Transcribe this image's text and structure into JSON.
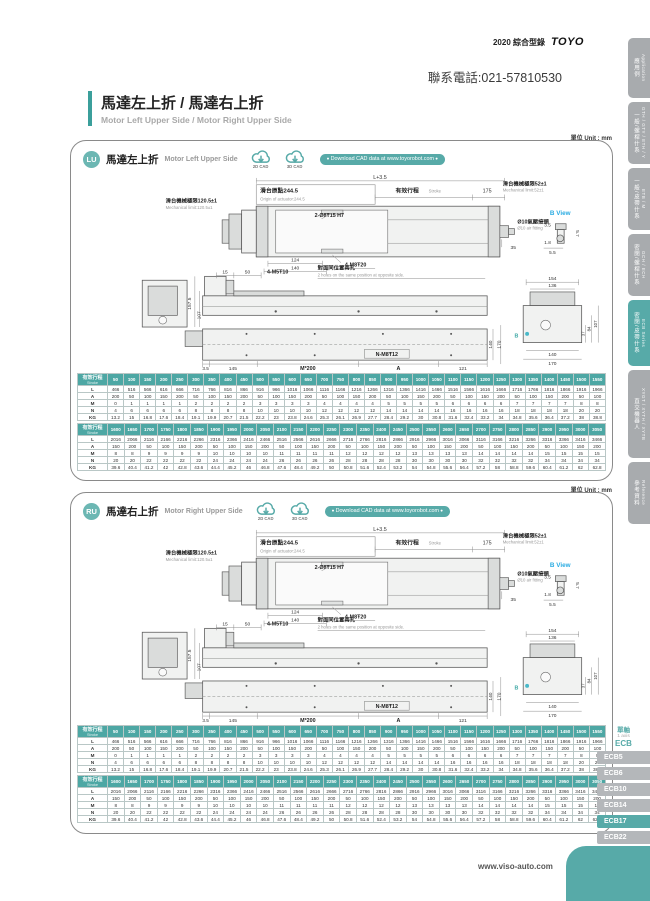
{
  "header": {
    "catalog": "2020 綜合型錄",
    "logo": "TOYO",
    "phone": "聯系電話:021-57810530"
  },
  "page_title": {
    "zh": "馬達左上折 / 馬達右上折",
    "en": "Motor Left Upper Side / Motor Right Upper Side"
  },
  "unit_label": "單位 Unit : mm",
  "sidebar": {
    "tabs": [
      {
        "zh": "應用例",
        "en": "Application",
        "active": false
      },
      {
        "zh": "一般/螺桿什系",
        "en": "GTH / GTY / ETH / Y",
        "active": false
      },
      {
        "zh": "一般/皮帶什系",
        "en": "ETB / M",
        "active": false
      },
      {
        "zh": "密閉/螺桿什系",
        "en": "GCH / ECH",
        "active": false
      },
      {
        "zh": "密閉/皮帶什系",
        "en": "ECB Series",
        "active": true
      },
      {
        "zh": "直交機器人",
        "en": "XYGT / XYTH / XYTB",
        "active": false
      },
      {
        "zh": "參考資料",
        "en": "Reference",
        "active": false
      }
    ]
  },
  "panels": [
    {
      "badge": "LU",
      "title_zh": "馬達左上折",
      "title_en": "Motor Left Upper Side"
    },
    {
      "badge": "RU",
      "title_zh": "馬達右上折",
      "title_en": "Motor Right Upper Side"
    }
  ],
  "cad": {
    "cad2d": "2D CAD",
    "cad3d": "3D CAD",
    "download": "Download CAD data at www.toyorobot.com"
  },
  "drawing": {
    "dim_l": "L+3.5",
    "origin_zh": "滑台原點244.5",
    "origin_en": "Origin of actuator:244.5",
    "stroke_zh": "有效行程",
    "stroke_en": "Stroke",
    "dim_175": "175",
    "mech120_zh": "滑台機械極限120.5±1",
    "mech120_en": "Mechanical limit:120.5±1",
    "mech52_zh": "滑台機械極限52±1",
    "mech52_en": "Mechanical limit:52±1",
    "holes_top": "2-Ø8Ŧ15 H7",
    "holes_m8": "4-M8Ŧ20",
    "dim_124": "124",
    "dim_140": "140",
    "air_zh": "Ø10氣壓接頭",
    "air_en": "Ø10 air fitting",
    "dim_35": "35",
    "b_view": "B View",
    "b_35": "3.5",
    "b_57": "5.7",
    "b_18": "1.8",
    "b_55": "5.5",
    "dim_15": "15",
    "dim_50": "50",
    "holes_m5": "4-M5Ŧ10",
    "opp_zh": "對面同位置兩孔",
    "opp_en": "2 holes on the same position at opposite side.",
    "dim_1575": "157.5",
    "dim_107": "107",
    "dim_3_5": "3.5",
    "dim_145": "145",
    "m200": "M*200",
    "dim_a": "A",
    "dim_121": "121",
    "n_m8": "N-M8Ŧ12",
    "side_140": "140",
    "side_170": "170",
    "end_154": "154",
    "end_136": "136",
    "end_37": "37",
    "end_84": "84",
    "end_107": "107",
    "end_140": "140",
    "end_170": "170",
    "b_arrow": "B"
  },
  "tables": {
    "t1": {
      "header_zh": "有效行程",
      "header_en": "Stroke",
      "strokes": [
        50,
        100,
        150,
        200,
        250,
        300,
        350,
        400,
        450,
        500,
        550,
        600,
        650,
        700,
        750,
        800,
        850,
        900,
        950,
        1000,
        1050,
        1100,
        1150,
        1200,
        1250,
        1300,
        1350,
        1400,
        1450,
        1500,
        1550
      ],
      "rows": [
        {
          "label": "L",
          "values": [
            466,
            516,
            566,
            616,
            666,
            716,
            766,
            816,
            866,
            916,
            966,
            1016,
            1066,
            1116,
            1166,
            1216,
            1266,
            1316,
            1366,
            1416,
            1466,
            1516,
            1566,
            1616,
            1666,
            1716,
            1766,
            1816,
            1866,
            1916,
            1966
          ]
        },
        {
          "label": "A",
          "values": [
            200,
            50,
            100,
            150,
            200,
            50,
            100,
            150,
            200,
            50,
            100,
            150,
            200,
            50,
            100,
            150,
            200,
            50,
            100,
            150,
            200,
            50,
            100,
            150,
            200,
            50,
            100,
            150,
            200,
            50,
            100
          ]
        },
        {
          "label": "M",
          "values": [
            0,
            1,
            1,
            1,
            1,
            2,
            2,
            2,
            2,
            3,
            3,
            3,
            3,
            4,
            4,
            4,
            4,
            5,
            5,
            5,
            5,
            6,
            6,
            6,
            6,
            7,
            7,
            7,
            7,
            8,
            8
          ]
        },
        {
          "label": "N",
          "values": [
            4,
            6,
            6,
            6,
            6,
            8,
            8,
            8,
            8,
            10,
            10,
            10,
            10,
            12,
            12,
            12,
            12,
            14,
            14,
            14,
            14,
            16,
            16,
            16,
            16,
            18,
            18,
            18,
            18,
            20,
            20
          ]
        },
        {
          "label": "KG",
          "values": [
            13.2,
            15,
            16.8,
            17.6,
            18.4,
            19.1,
            19.9,
            20.7,
            21.5,
            22.2,
            23,
            23.8,
            24.6,
            25.3,
            26.1,
            26.9,
            27.7,
            28.4,
            29.2,
            30,
            30.8,
            31.6,
            32.4,
            33.2,
            34,
            34.8,
            35.6,
            36.4,
            37.2,
            38,
            38.8
          ]
        }
      ]
    },
    "t2": {
      "header_zh": "有效行程",
      "header_en": "Stroke",
      "strokes": [
        1600,
        1650,
        1700,
        1750,
        1800,
        1850,
        1900,
        1950,
        2000,
        2050,
        2100,
        2150,
        2200,
        2250,
        2300,
        2350,
        2400,
        2450,
        2500,
        2550,
        2600,
        2650,
        2700,
        2750,
        2800,
        2850,
        2900,
        2950,
        3000,
        3050
      ],
      "rows": [
        {
          "label": "L",
          "values": [
            2016,
            2066,
            2116,
            2166,
            2216,
            2266,
            2316,
            2366,
            2416,
            2466,
            2516,
            2566,
            2616,
            2666,
            2716,
            2766,
            2816,
            2866,
            2916,
            2966,
            3016,
            3066,
            3116,
            3166,
            3216,
            3266,
            3316,
            3366,
            3416,
            3466
          ]
        },
        {
          "label": "A",
          "values": [
            150,
            200,
            50,
            100,
            150,
            200,
            50,
            100,
            150,
            200,
            50,
            100,
            150,
            200,
            50,
            100,
            150,
            200,
            50,
            100,
            150,
            200,
            50,
            100,
            150,
            200,
            50,
            100,
            150,
            200
          ]
        },
        {
          "label": "M",
          "values": [
            8,
            8,
            9,
            9,
            9,
            9,
            10,
            10,
            10,
            10,
            11,
            11,
            11,
            11,
            12,
            12,
            12,
            12,
            13,
            13,
            13,
            13,
            14,
            14,
            14,
            14,
            15,
            15,
            15,
            15
          ]
        },
        {
          "label": "N",
          "values": [
            20,
            20,
            22,
            22,
            22,
            22,
            24,
            24,
            24,
            24,
            26,
            26,
            26,
            26,
            28,
            28,
            28,
            28,
            30,
            30,
            30,
            30,
            32,
            32,
            32,
            32,
            34,
            34,
            34,
            34
          ]
        },
        {
          "label": "KG",
          "values": [
            39.6,
            40.4,
            41.2,
            42,
            42.8,
            43.6,
            44.4,
            45.2,
            46,
            46.8,
            47.6,
            48.4,
            49.2,
            50,
            50.8,
            51.6,
            52.4,
            53.2,
            54,
            54.8,
            55.6,
            56.4,
            57.2,
            58,
            58.8,
            59.6,
            60.4,
            61.2,
            62,
            62.8
          ]
        }
      ]
    }
  },
  "ecb_nav": {
    "group_zh": "單軸",
    "group_en": "1 axis",
    "group_code": "ECB",
    "items": [
      "ECB5",
      "ECB6",
      "ECB10",
      "ECB14",
      "ECB17",
      "ECB22"
    ],
    "active": "ECB17"
  },
  "footer": {
    "url": "www.viso-auto.com"
  }
}
